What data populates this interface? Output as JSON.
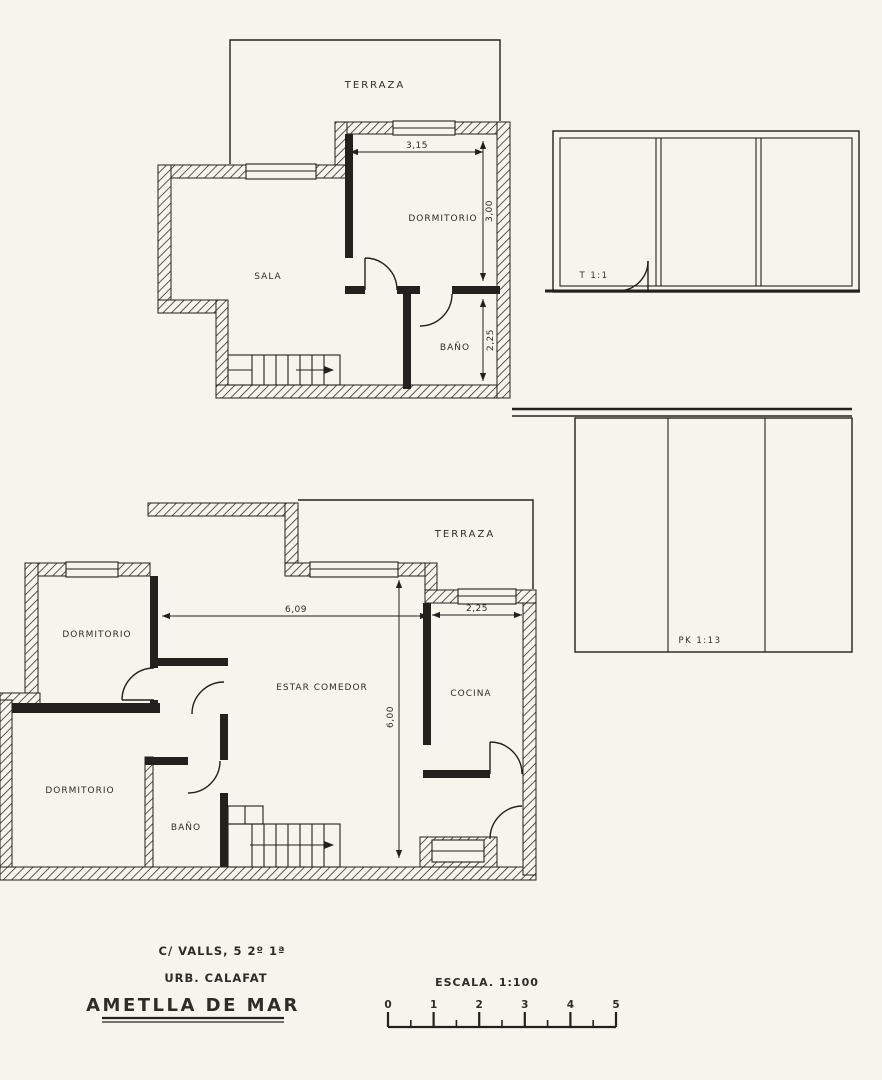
{
  "colors": {
    "paper": "#f6f4ec",
    "ink": "#22211d"
  },
  "upper_plan": {
    "rooms": {
      "terraza": "TERRAZA",
      "dormitorio": "DORMITORIO",
      "sala": "SALA",
      "bano": "BAÑO"
    },
    "dims": {
      "width": "3,15",
      "height": "3,00",
      "bath_height": "2,25"
    }
  },
  "lower_plan": {
    "rooms": {
      "terraza": "TERRAZA",
      "dormitorio_top": "DORMITORIO",
      "dormitorio_bottom": "DORMITORIO",
      "estar": "ESTAR COMEDOR",
      "cocina": "COCINA",
      "bano": "BAÑO"
    },
    "dims": {
      "living_width": "6,09",
      "kitchen_width": "2,25",
      "height": "6,00"
    }
  },
  "elevations": {
    "top_label": "T 1:1",
    "bottom_label": "PK 1:13"
  },
  "footer": {
    "address_line1": "C/ VALLS, 5  2º 1ª",
    "address_line2": "URB. CALAFAT",
    "city": "AMETLLA DE MAR",
    "scale_label": "ESCALA. 1:100",
    "scale_ticks": [
      "0",
      "1",
      "2",
      "3",
      "4",
      "5"
    ]
  }
}
